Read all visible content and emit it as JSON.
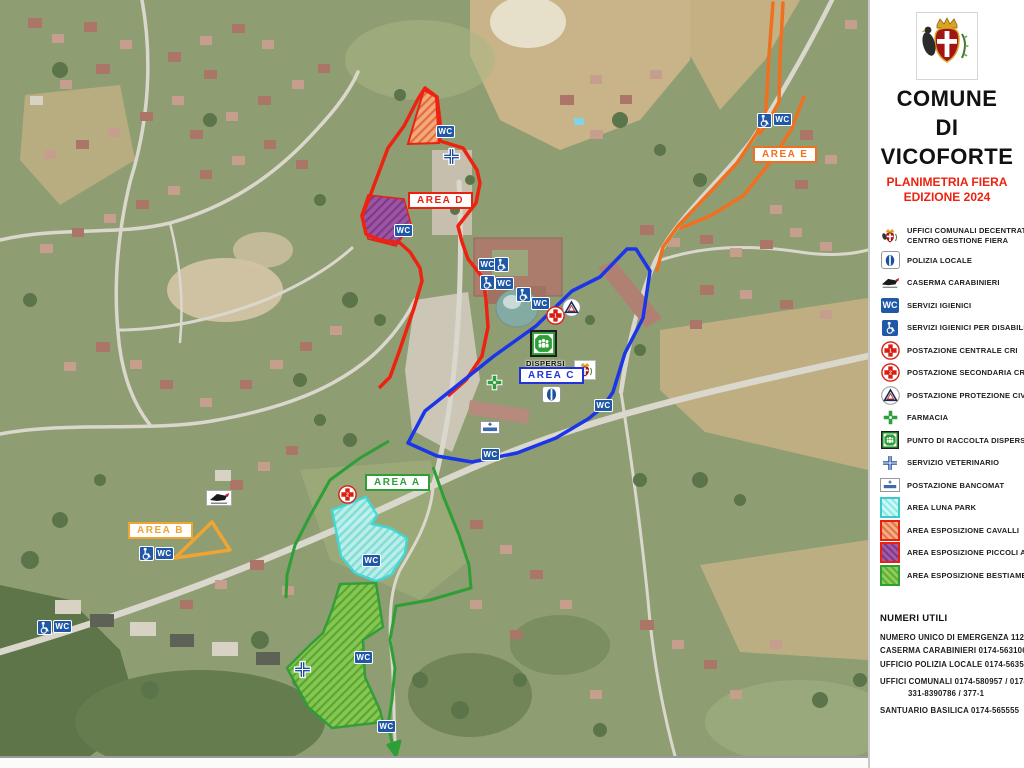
{
  "header": {
    "title_line1": "COMUNE",
    "title_line2": "DI",
    "title_line3": "VICOFORTE",
    "subtitle_line1": "PLANIMETRIA FIERA",
    "subtitle_line2": "EDIZIONE 2024"
  },
  "legend": {
    "items": [
      {
        "icon": "municipal-crest-icon",
        "label": "UFFICI COMUNALI DECENTRATI",
        "label2": "CENTRO GESTIONE FIERA"
      },
      {
        "icon": "local-police-icon",
        "label": "POLIZIA LOCALE"
      },
      {
        "icon": "carabinieri-icon",
        "label": "CASERMA CARABINIERI"
      },
      {
        "icon": "wc-icon",
        "label": "SERVIZI IGIENICI"
      },
      {
        "icon": "accessible-wc-icon",
        "label": "SERVIZI IGIENICI PER DISABILI"
      },
      {
        "icon": "red-cross-1-icon",
        "label": "POSTAZIONE CENTRALE CRI"
      },
      {
        "icon": "red-cross-2-icon",
        "label": "POSTAZIONE SECONDARIA CRI"
      },
      {
        "icon": "civil-protection-icon",
        "label": "POSTAZIONE PROTEZIONE CIVILE"
      },
      {
        "icon": "pharmacy-icon",
        "label": "FARMACIA"
      },
      {
        "icon": "lost-people-point-icon",
        "label": "PUNTO DI RACCOLTA DISPERSI"
      },
      {
        "icon": "veterinary-icon",
        "label": "SERVIZIO VETERINARIO"
      },
      {
        "icon": "atm-icon",
        "label": "POSTAZIONE BANCOMAT"
      },
      {
        "icon": "luna-park-swatch",
        "label": "AREA LUNA PARK"
      },
      {
        "icon": "horses-swatch",
        "label": "AREA ESPOSIZIONE CAVALLI"
      },
      {
        "icon": "small-animals-swatch",
        "label": "AREA ESPOSIZIONE PICCOLI ANIMALI"
      },
      {
        "icon": "livestock-swatch",
        "label": "AREA ESPOSIZIONE BESTIAME"
      }
    ]
  },
  "map": {
    "wc_label": "WC",
    "dispersi_label": "DISPERSI",
    "labels": {
      "area_a": "AREA A",
      "area_b": "AREA B",
      "area_c": "AREA C",
      "area_d": "AREA D",
      "area_e": "AREA E"
    },
    "cri_numbers": {
      "central": "1",
      "secondary": "2"
    }
  },
  "useful_numbers": {
    "title": "NUMERI UTILI",
    "lines": [
      "NUMERO UNICO DI EMERGENZA 112",
      "CASERMA CARABINIERI 0174-563106",
      "UFFICIO POLIZIA LOCALE 0174-563594",
      "UFFICI COMUNALI  0174-580957 / 0174-",
      "331-8390786 / 377-1",
      "SANTUARIO BASILICA 0174-565555"
    ]
  },
  "colors": {
    "accent_red": "#ee2211",
    "area_a_green": "#2e9e36",
    "area_b_orange": "#f0a432",
    "area_c_blue": "#2133d8",
    "area_d_red": "#e8220f",
    "area_e_orange": "#f07020",
    "luna_park_cyan": "#3ec9c9",
    "service_blue": "#2058a8"
  }
}
